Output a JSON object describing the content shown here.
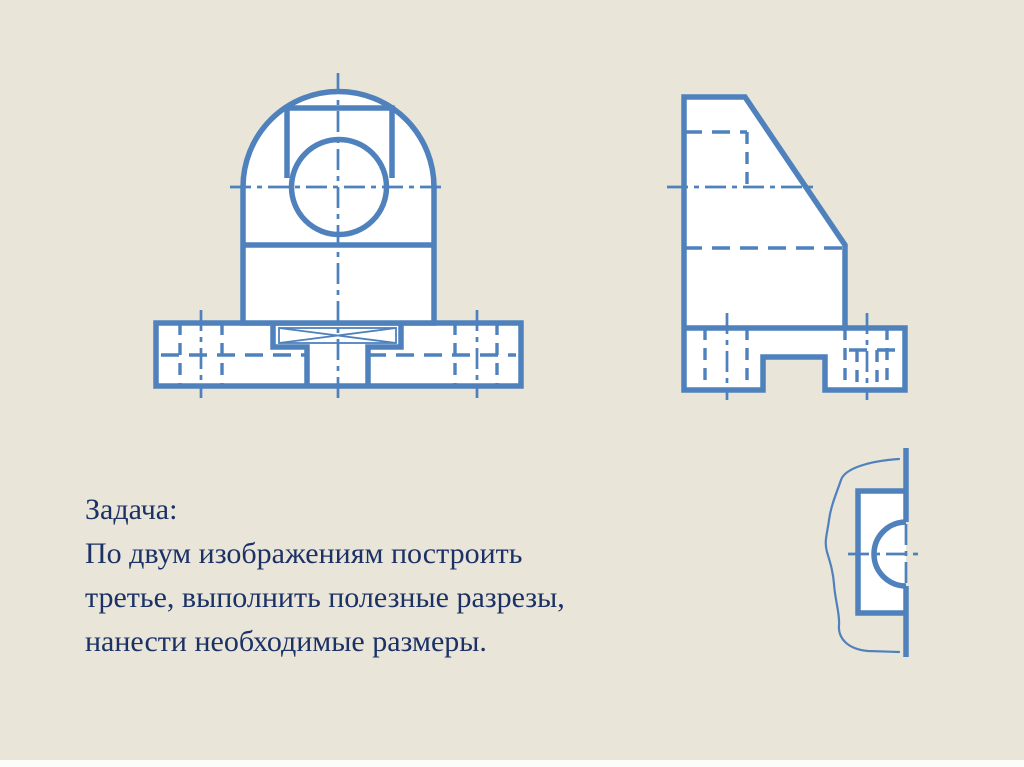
{
  "slide": {
    "background_color": "#e9e5d9",
    "bottom_strip_color": "#fcfcf8",
    "drawing_line_color": "#4f81bd",
    "drawing_fill_color": "#ffffff",
    "text_color": "#1c3166"
  },
  "task": {
    "lines": [
      "Задача:",
      "По двум изображениям построить",
      "третье, выполнить полезные разрезы,",
      "нанести необходимые размеры."
    ]
  }
}
